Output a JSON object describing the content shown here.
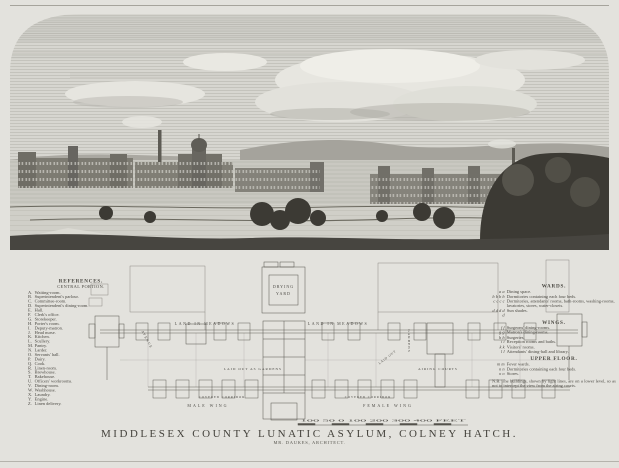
{
  "page": {
    "paper_color": "#e3e2dd",
    "ink_color": "#3b3935"
  },
  "caption": {
    "title": "MIDDLESEX COUNTY LUNATIC ASYLUM, COLNEY HATCH.",
    "architect": "MR. DAUKES, ARCHITECT."
  },
  "left_references": {
    "title": "REFERENCES.",
    "subtitle": "CENTRAL PORTION.",
    "items": [
      {
        "k": "A.",
        "t": "Waiting-room."
      },
      {
        "k": "B.",
        "t": "Superintendent's parlour."
      },
      {
        "k": "C.",
        "t": "Committee-room."
      },
      {
        "k": "D.",
        "t": "Superintendent's dining-room."
      },
      {
        "k": "E.",
        "t": "Hall."
      },
      {
        "k": "F.",
        "t": "Clerk's office."
      },
      {
        "k": "G.",
        "t": "Storekeeper."
      },
      {
        "k": "H.",
        "t": "Porter's room."
      },
      {
        "k": "I.",
        "t": "Deputy-matron."
      },
      {
        "k": "J.",
        "t": "Head nurse."
      },
      {
        "k": "K.",
        "t": "Kitchen."
      },
      {
        "k": "L.",
        "t": "Scullery."
      },
      {
        "k": "M.",
        "t": "Pantry."
      },
      {
        "k": "N.",
        "t": "Larder."
      },
      {
        "k": "O.",
        "t": "Servants' hall."
      },
      {
        "k": "P.",
        "t": "Dairy."
      },
      {
        "k": "Q.",
        "t": "Cook."
      },
      {
        "k": "R.",
        "t": "Linen-room."
      },
      {
        "k": "S.",
        "t": "Brewhouse."
      },
      {
        "k": "T.",
        "t": "Bakehouse."
      },
      {
        "k": "U.",
        "t": "Officers' workrooms."
      },
      {
        "k": "V.",
        "t": "Dining-room."
      },
      {
        "k": "W.",
        "t": "Washhouse."
      },
      {
        "k": "X.",
        "t": "Laundry."
      },
      {
        "k": "Y.",
        "t": "Engine."
      },
      {
        "k": "Z.",
        "t": "Linen delivery."
      }
    ]
  },
  "right_references": {
    "sections": [
      {
        "header": "WARDS.",
        "items": [
          {
            "m": "a a",
            "t": "Dining space."
          },
          {
            "m": "b b b b",
            "t": "Dormitories containing each four beds."
          },
          {
            "m": "c c c c",
            "t": "Dormitories, attendants' rooms, bath-rooms, washing-rooms, lavatories, stores, water-closets."
          },
          {
            "m": "d d d d d",
            "t": "Sun shades."
          }
        ]
      },
      {
        "header": "WINGS.",
        "items": [
          {
            "m": "f f",
            "t": "Surgeons' dining-rooms."
          },
          {
            "m": "g g",
            "t": "Matron's dining-rooms."
          },
          {
            "m": "h h",
            "t": "Surgeries."
          },
          {
            "m": "i i",
            "t": "Reception rooms and baths."
          },
          {
            "m": "k k",
            "t": "Visitors' rooms."
          },
          {
            "m": "l l",
            "t": "Attendants' dining-hall and library."
          }
        ]
      },
      {
        "header": "UPPER FLOOR.",
        "items": [
          {
            "m": "m m",
            "t": "Fever wards."
          },
          {
            "m": "n n",
            "t": "Dormitories containing each four beds."
          },
          {
            "m": "o o",
            "t": "Stores."
          }
        ]
      }
    ],
    "note": "N.B. The buildings, shown by light lines, are on a lower level, so as not to intercept the view from the airing courts."
  },
  "plan": {
    "drying_yard_1": "DRYING",
    "drying_yard_2": "YARD",
    "land_left": "LAND IN MEADOWS",
    "land_right": "LAND IN MEADOWS",
    "gardens_vertical": "GARDENS",
    "avenue_diag": "AVENUE",
    "laid_out_diag": "LAID OUT",
    "laid_out": "LAID OUT AS GARDENS",
    "airing_courts": "AIRING COURTS",
    "covered_corridor_left": "COVERED CORRIDOR",
    "covered_corridor_right": "COVERED CORRIDOR",
    "male_wing": "MALE WING",
    "female_wing": "FEMALE WING",
    "scale_text": "100 50 0 100 200 300 400 FEET"
  }
}
